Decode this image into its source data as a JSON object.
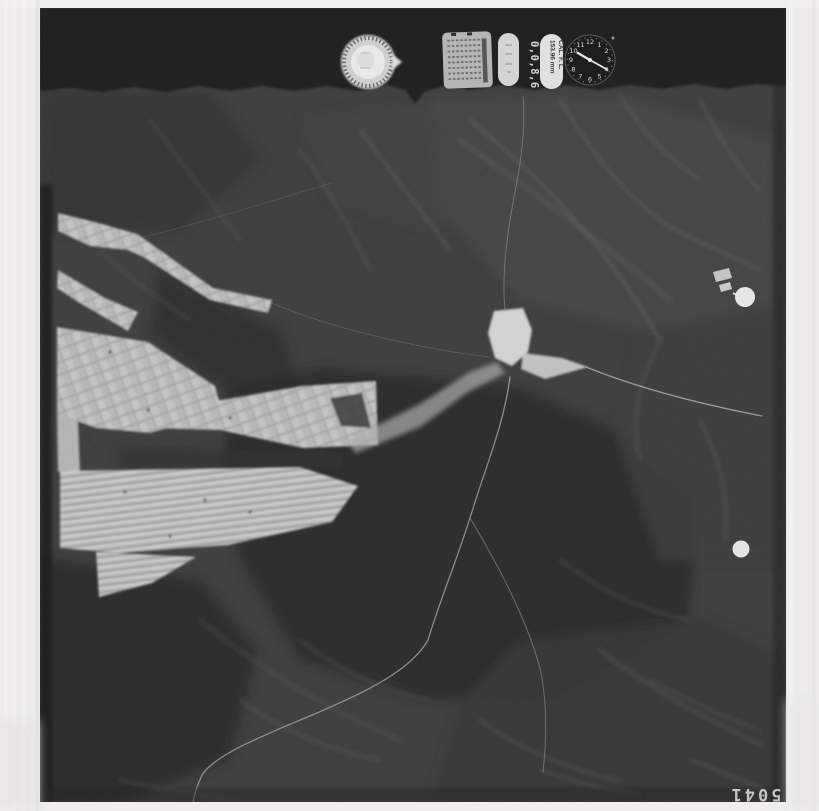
{
  "document": {
    "kind": "scanned aerial survey photograph",
    "frame_number": "5041",
    "frame_number_orientation": "rotated-180"
  },
  "instrument_strip": {
    "counter_value": "0,0,8,6",
    "focal_length": {
      "line1": "CAL. F. L.",
      "line2": "153.96 mm"
    },
    "data_plate_text": "illegible",
    "record_pill_text": "illegible",
    "clock_numerals": [
      "1",
      "2",
      "3",
      "4",
      "5",
      "6",
      "7",
      "8",
      "9",
      "10",
      "11",
      "12"
    ]
  },
  "palette": {
    "margin": "#edecea",
    "exposure_strip": "#242424",
    "terrain_base": "#3f3f3f",
    "terrain_shadow": "#2c2c2c",
    "fields_light": "#bfbfbf",
    "bright_marks": "#ededed"
  }
}
